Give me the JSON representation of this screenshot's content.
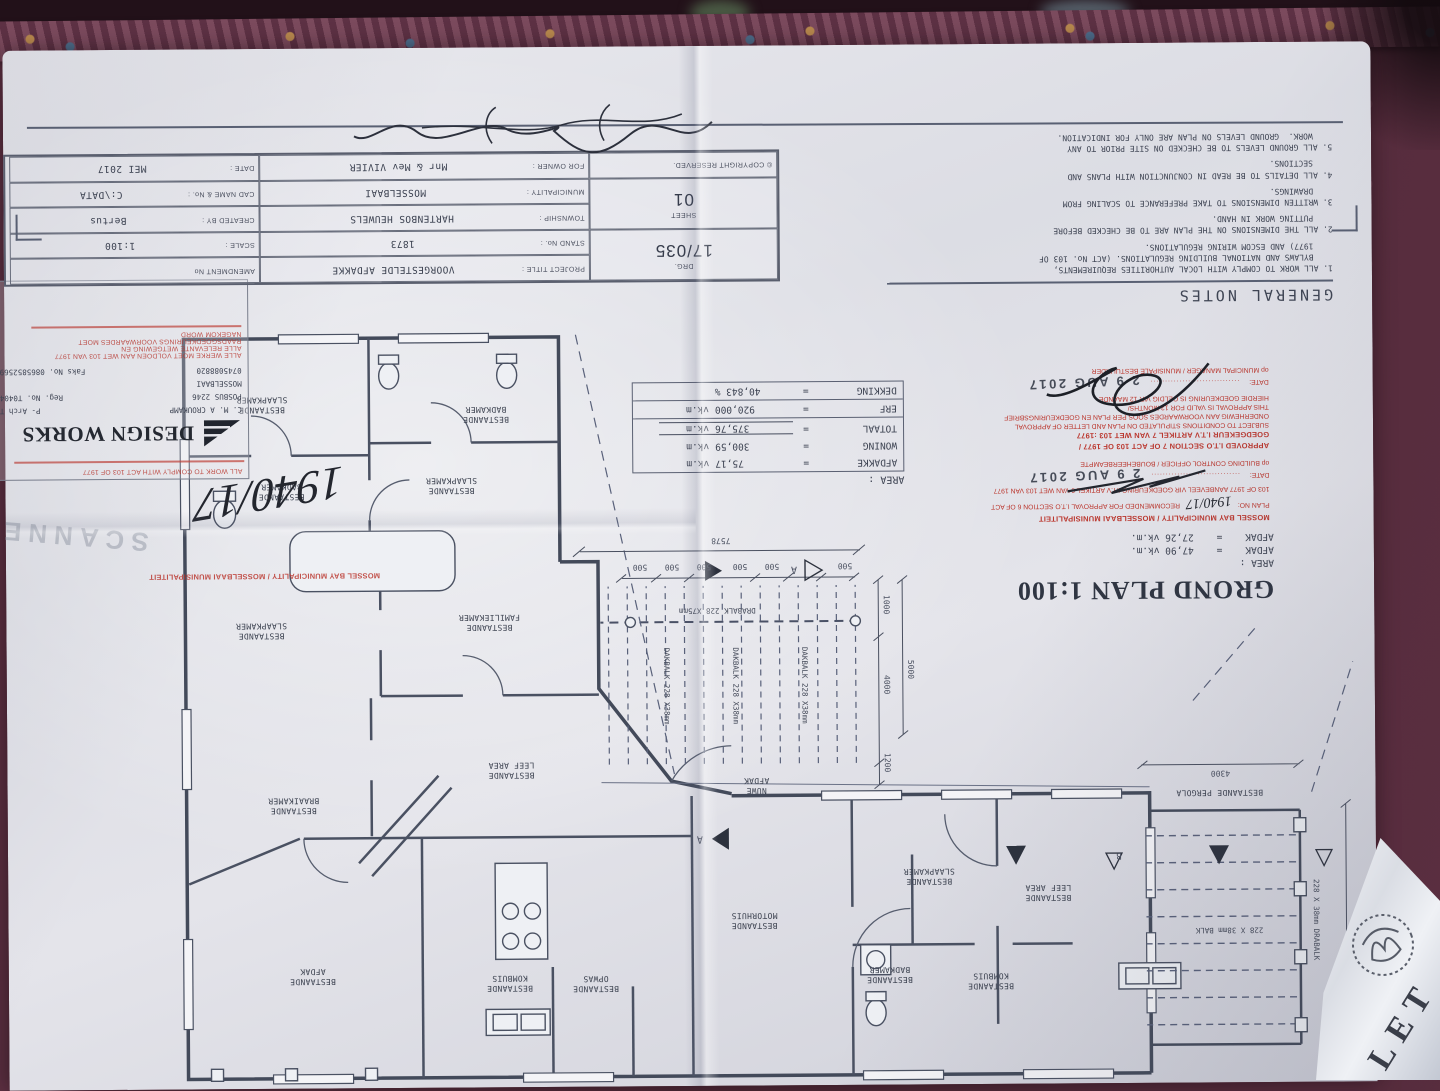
{
  "title_block": {
    "drg_label": "DRG.",
    "drg_no": "17/035",
    "sheet_label": "SHEET",
    "sheet_no": "01",
    "copyright": "© COPYRIGHT RESERVED.",
    "fields": [
      {
        "label": "PROJECT TITLE :",
        "value": "VOORGESTELDE AFDAKKE"
      },
      {
        "label": "AMENDMENT No",
        "value": ""
      },
      {
        "label": "STAND No. :",
        "value": "1873"
      },
      {
        "label": "SCALE :",
        "value": "1:100"
      },
      {
        "label": "TOWNSHIP :",
        "value": "HARTENBOS HEUWELS"
      },
      {
        "label": "CREATED BY :",
        "value": "Bertus"
      },
      {
        "label": "MUNICIPALITY :",
        "value": "MOSSELBAAI"
      },
      {
        "label": "CAD NAME & No. :",
        "value": "C:\\DATA"
      },
      {
        "label": "FOR OWNER :",
        "value": "Mnr & Mev VIVIER"
      },
      {
        "label": "DATE :",
        "value": "MEI 2017"
      }
    ]
  },
  "general_notes": {
    "title": "GENERAL NOTES",
    "notes": [
      "1. ALL WORK TO COMPLY WITH LOCAL AUTHORITIES REQUIREMENTS,\n    BYLAWS AND NATIONAL BUILDING REGULATIONS. (ACT No. 103 OF\n    1977) AND ESCOM WIRING REGULATIONS.",
      "2. ALL THE DIMENSIONS ON THE PLAN ARE TO BE CHECKED BEFORE\n    PUTTING WORK IN HAND.",
      "3. WRITTEN DIMENSIONS TO TAKE PREFERANCE TO SCALING FROM\n    DRAWINGS.",
      "4. ALL DETAILS TO BE READ IN CONJUNCTION WITH PLANS AND\n    SECTIONS.",
      "5. ALL GROUND LEVELS TO BE CHECKED ON SITE PRIOR TO ANY\n    WORK.  GROUND LEVELS ON PLAN ARE ONLY FOR INDICATION."
    ]
  },
  "plan_heading": {
    "title": "GROND PLAN 1:100",
    "area_label": "AREA :",
    "lines": [
      "AFDAK    =    47,90 vk.m.",
      "AFDAK    =    27,26 vk.m."
    ]
  },
  "area_table": {
    "header": "AREA :",
    "eq": "=",
    "rows": [
      {
        "name": "AFDAKKE",
        "value": "75,17",
        "unit": "vk.m"
      },
      {
        "name": "WONING",
        "value": "300,59",
        "unit": "vk.m"
      },
      {
        "name": "TOTAAL",
        "value": "375,76",
        "unit": "vk.m"
      },
      {
        "name": "ERF",
        "value": "920,000",
        "unit": "vk.m"
      },
      {
        "name": "DEKKING",
        "value": "40,843 %",
        "unit": ""
      }
    ]
  },
  "design_works": {
    "name": "DESIGN WORKS",
    "person": "C. M. A CROUKAMP",
    "person_title": "P- Arch T",
    "pobox": "POSBUS 2246",
    "reg": "Reg. No. T0404",
    "city": "MOSSELBAAI",
    "phone": "0745088820",
    "fax": "Faks No.  0865852569",
    "red_overlay": [
      "ALL WORK TO COMPLY WITH ACT 103 OF 1977",
      "ALLE WERKE MOET VOLDOEN AAN WET 103 VAN 1977",
      "ALLE RELEVANTE WETGEWING EN",
      "RAADSGOEDKEURINGS VOORWAARDES MOET",
      "NAGEKOM WORD"
    ]
  },
  "stamps": {
    "municipality_header": "MOSSEL BAY MUNICIPALITY / MOSSELBAAI MUNISIPALITEIT",
    "date_stamp": "2 9 AUG 2017",
    "scanned": "SCANNED",
    "plan_no": "1940/17",
    "recommend": {
      "plan_no_label": "PLAN NO:",
      "line1": "RECOMMENDED FOR APPROVAL I.T.O SECTION 6 OF ACT",
      "line2": "103 OF 1977 AANBEVEEL VIR GOEDKEURING I.T.V ARTIKEL 6 VAN WET 103 VAN 1977",
      "date_label": "DATE:",
      "leader": "...............................",
      "officer": "op BUILDING CONTROL OFFICER / BOUBEHEERBEAMPTE"
    },
    "approve": {
      "line1": "APPROVED I.T.O SECTION 7 OF ACT 103 OF 1977 /",
      "line2": "GOEDGEKEUR I.T.V ARTIKEL 7 VAN WET 103 :1977",
      "line3": "SUBJECT TO CONDITIONS STIPULATED ON PLAN AND LETTER OF APPROVAL",
      "line4": "ONDERHEWIG AAN VOORWAARDES SOOS PER PLAN EN GOEDKEURINGSBRIEF",
      "line5": "THIS APPROVAL IS VALID FOR 12 MONTHS/",
      "line6": "HIERDIE GOEDKEURING IS GELDIG VIR 12 MAANDE",
      "date_label": "DATE:",
      "leader": "...............................",
      "officer": "op MUNICIPAL MANAGER / MUNISIPALE BESTUURDER"
    }
  },
  "plan": {
    "rooms": [
      "BESTAANDE\nSLAAPKAMER",
      "BESTAANDE\nBADKAMER",
      "BESTAANDE\nSLAAPKAMER",
      "BESTAANDE\nBADKAMER",
      "BESTAANDE\nSLAAPKAMER",
      "BESTAANDE\nFAMILIEKAMER",
      "BESTAANDE\nLEEF AREA",
      "BESTAANDE\nBRAAIKAMER",
      "BESTAANDE\nAFDAK",
      "BESTAANDE\nKOMBUIS",
      "BESTAANDE\nOPWAS",
      "BESTAANDE\nMOTORHUIS",
      "BESTAANDE\nSLAAPKAMER",
      "BESTAANDE\nLEEF AREA",
      "BESTAANDE\nBADKAMER",
      "BESTAANDE\nKOMBUIS",
      "BESTAANDE PERGOLA",
      "NUWE\nAFDAK"
    ],
    "dims": {
      "d7578": "7578",
      "d500": "500",
      "d1000": "1000",
      "d4000": "4000",
      "d5000": "5000",
      "d1200": "1200",
      "d4300": "4300",
      "d6340": "6340"
    },
    "beams": {
      "dakbalk": "DAKBALK 228 X38mm",
      "drabalk": "DRABALK 228 X75mm",
      "balk": "228 X 38mm BALK",
      "drabalk2": "228 X 38mm DRABALK"
    },
    "markers": {
      "a": "A",
      "b": "B"
    }
  },
  "rolled_doc": {
    "letters": "LET"
  }
}
